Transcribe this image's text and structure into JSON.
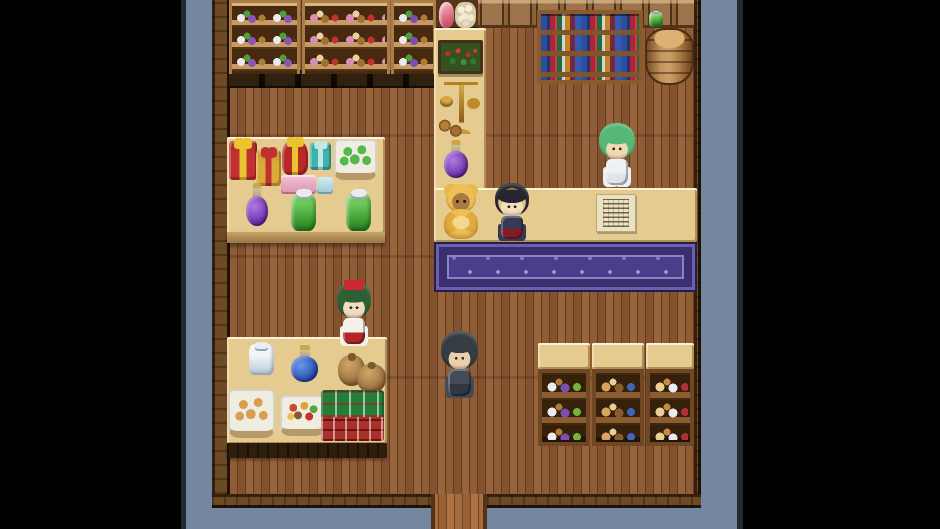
{
  "colors": {
    "letterbox": "#000000",
    "backdrop_blue": "#7487a0",
    "frame_edge": "#232931",
    "wall_brown": "#6d4a26",
    "floor_wood": "#8a5732",
    "corridor_wood": "#9c6538",
    "counter_tan": "#e6cb90",
    "rug_purple": "#4c3c8c",
    "shelf_wood": "#aa7d49",
    "scale_gold": "#d9a845"
  },
  "scene": {
    "width": 940,
    "height": 529,
    "items": [
      {
        "name": "backdrop",
        "cls": "blue",
        "x": 186,
        "y": 0,
        "w": 551,
        "h": 529,
        "interactable": false
      },
      {
        "name": "frame-edge-left",
        "cls": "edge",
        "x": 181,
        "y": 0,
        "w": 5,
        "h": 529,
        "interactable": false
      },
      {
        "name": "frame-edge-right",
        "cls": "edge",
        "x": 737,
        "y": 0,
        "w": 6,
        "h": 529,
        "interactable": false
      },
      {
        "name": "shop-floor",
        "cls": "floor",
        "x": 230,
        "y": 0,
        "w": 464,
        "h": 497,
        "interactable": true
      },
      {
        "name": "wall-west",
        "cls": "wall-v",
        "x": 212,
        "y": 0,
        "w": 18,
        "h": 508,
        "interactable": false
      },
      {
        "name": "wall-east",
        "cls": "wall-v",
        "x": 694,
        "y": 0,
        "w": 7,
        "h": 508,
        "interactable": false
      },
      {
        "name": "wall-south-left",
        "cls": "wall-h",
        "x": 212,
        "y": 494,
        "w": 219,
        "h": 14,
        "interactable": false
      },
      {
        "name": "wall-south-right",
        "cls": "wall-h",
        "x": 487,
        "y": 494,
        "w": 214,
        "h": 14,
        "interactable": false
      },
      {
        "name": "exit-doorway-floor",
        "cls": "floor-exit",
        "x": 431,
        "y": 494,
        "w": 56,
        "h": 35,
        "interactable": true
      },
      {
        "name": "shelf-base-shadow",
        "cls": "shelfbase",
        "x": 229,
        "y": 70,
        "w": 207,
        "h": 18,
        "interactable": false
      },
      {
        "name": "shelf-jars-left",
        "cls": "shelf",
        "x": 229,
        "y": 0,
        "w": 71,
        "h": 74,
        "interactable": false,
        "vars": {
          "--d1": "#ece9f0",
          "--d2": "#8a53b8",
          "--d3": "#b07a38",
          "--d4": "#4f9e3a"
        }
      },
      {
        "name": "shelf-goods-plush",
        "cls": "shelf",
        "x": 302,
        "y": 0,
        "w": 88,
        "h": 74,
        "interactable": false,
        "vars": {
          "--d1": "#d98fb5",
          "--d2": "#a5702f",
          "--d3": "#c23131",
          "--d4": "#e8d3a0"
        }
      },
      {
        "name": "shelf-jars-right",
        "cls": "shelf",
        "x": 391,
        "y": 0,
        "w": 45,
        "h": 74,
        "interactable": false,
        "vars": {
          "--d1": "#ece9f0",
          "--d2": "#7a4fb0",
          "--d3": "#b07a38",
          "--d4": "#4f9e3a"
        }
      },
      {
        "name": "ham-and-eggs-table",
        "cls": "hamtable",
        "x": 436,
        "y": 0,
        "w": 42,
        "h": 30,
        "interactable": false
      },
      {
        "name": "wall-cabinets",
        "cls": "cabinet",
        "x": 478,
        "y": 0,
        "w": 216,
        "h": 28,
        "interactable": false
      },
      {
        "name": "bookshelf",
        "cls": "bookshelf",
        "x": 537,
        "y": 10,
        "w": 106,
        "h": 74,
        "interactable": false
      },
      {
        "name": "barrel",
        "cls": "barrel",
        "x": 645,
        "y": 28,
        "w": 49,
        "h": 57,
        "interactable": false
      },
      {
        "name": "green-box-on-cabinet",
        "cls": "jar-green",
        "x": 649,
        "y": 12,
        "w": 14,
        "h": 15,
        "interactable": false
      },
      {
        "name": "counter-vertical",
        "cls": "tan",
        "x": 434,
        "y": 28,
        "w": 52,
        "h": 214,
        "interactable": false
      },
      {
        "name": "counter-horizontal",
        "cls": "tan",
        "x": 434,
        "y": 188,
        "w": 263,
        "h": 54,
        "interactable": false
      },
      {
        "name": "purple-rug",
        "cls": "rug",
        "x": 434,
        "y": 242,
        "w": 263,
        "h": 50,
        "interactable": false
      },
      {
        "name": "flower-planter",
        "cls": "flowerbox",
        "x": 438,
        "y": 40,
        "w": 45,
        "h": 34,
        "interactable": false
      },
      {
        "name": "balance-scale",
        "cls": "scale",
        "x": 437,
        "y": 80,
        "w": 48,
        "h": 52,
        "interactable": false
      },
      {
        "name": "clay-pots",
        "cls": "pots",
        "x": 437,
        "y": 116,
        "w": 26,
        "h": 24,
        "interactable": false
      },
      {
        "name": "potion-purple-counter",
        "cls": "potion",
        "x": 444,
        "y": 140,
        "w": 24,
        "h": 38,
        "interactable": false,
        "vars": {
          "--liq1": "#b27ae0",
          "--liq2": "#5f24a4"
        }
      },
      {
        "name": "gift-table",
        "cls": "tan",
        "x": 227,
        "y": 137,
        "w": 158,
        "h": 97,
        "interactable": false
      },
      {
        "name": "gift-table-front",
        "cls": "tanfront",
        "x": 227,
        "y": 232,
        "w": 158,
        "h": 11,
        "interactable": false
      },
      {
        "name": "gift-box-red",
        "cls": "gift",
        "x": 229,
        "y": 141,
        "w": 28,
        "h": 39,
        "interactable": false,
        "vars": {
          "--c1": "#c23131",
          "--rb": "#e9c430"
        }
      },
      {
        "name": "gift-box-gold",
        "cls": "gift",
        "x": 256,
        "y": 150,
        "w": 25,
        "h": 36,
        "interactable": false,
        "vars": {
          "--c1": "#dcaa3a",
          "--rb": "#c23131"
        }
      },
      {
        "name": "gift-box-round-red",
        "cls": "gift round",
        "x": 282,
        "y": 140,
        "w": 26,
        "h": 35,
        "interactable": false,
        "vars": {
          "--c1": "#b82a2a",
          "--rb": "#e9c430"
        }
      },
      {
        "name": "gift-box-teal",
        "cls": "gift",
        "x": 310,
        "y": 143,
        "w": 21,
        "h": 27,
        "interactable": false,
        "vars": {
          "--c1": "#3fb3ad",
          "--rb": "#bfe8e6"
        }
      },
      {
        "name": "box-pink",
        "cls": "boxp",
        "x": 281,
        "y": 175,
        "w": 35,
        "h": 19,
        "interactable": false
      },
      {
        "name": "box-teal-small",
        "cls": "boxt",
        "x": 317,
        "y": 177,
        "w": 16,
        "h": 17,
        "interactable": false
      },
      {
        "name": "basket-green-fruit",
        "cls": "basket",
        "x": 334,
        "y": 139,
        "w": 43,
        "h": 41,
        "interactable": false,
        "vars": {
          "--dot": "#54b84a"
        }
      },
      {
        "name": "potion-purple-table",
        "cls": "potion",
        "x": 246,
        "y": 183,
        "w": 22,
        "h": 43,
        "interactable": false,
        "vars": {
          "--liq1": "#b27ae0",
          "--liq2": "#5f24a4"
        }
      },
      {
        "name": "jar-green-left",
        "cls": "jar-green",
        "x": 291,
        "y": 193,
        "w": 25,
        "h": 38,
        "interactable": false
      },
      {
        "name": "jar-green-right",
        "cls": "jar-green",
        "x": 346,
        "y": 193,
        "w": 25,
        "h": 38,
        "interactable": false
      },
      {
        "name": "provisions-table",
        "cls": "tan",
        "x": 227,
        "y": 337,
        "w": 160,
        "h": 107,
        "interactable": false
      },
      {
        "name": "provisions-table-front",
        "cls": "darkfront",
        "x": 227,
        "y": 443,
        "w": 160,
        "h": 15,
        "interactable": false
      },
      {
        "name": "jar-white-salt",
        "cls": "jar-white",
        "x": 249,
        "y": 344,
        "w": 25,
        "h": 31,
        "interactable": false
      },
      {
        "name": "potion-blue",
        "cls": "potion",
        "x": 291,
        "y": 345,
        "w": 27,
        "h": 37,
        "interactable": false,
        "vars": {
          "--liq1": "#6a9ae8",
          "--liq2": "#1c3fa8"
        }
      },
      {
        "name": "sack-back",
        "cls": "sack",
        "x": 338,
        "y": 355,
        "w": 27,
        "h": 31,
        "interactable": false
      },
      {
        "name": "sack-front",
        "cls": "sack",
        "x": 357,
        "y": 364,
        "w": 29,
        "h": 29,
        "interactable": false
      },
      {
        "name": "basket-bread",
        "cls": "basket",
        "x": 228,
        "y": 389,
        "w": 47,
        "h": 49,
        "interactable": false,
        "vars": {
          "--dot": "#d99f4e"
        }
      },
      {
        "name": "basket-vegetables",
        "cls": "basket mixed",
        "x": 280,
        "y": 395,
        "w": 45,
        "h": 41,
        "interactable": false
      },
      {
        "name": "plaid-cloth",
        "cls": "plaid",
        "x": 321,
        "y": 390,
        "w": 63,
        "h": 51,
        "interactable": false
      },
      {
        "name": "teddy-bear-plush",
        "cls": "teddy",
        "x": 442,
        "y": 184,
        "w": 38,
        "h": 55,
        "interactable": false
      },
      {
        "name": "npc-girl-bonnet",
        "cls": "chibi",
        "x": 492,
        "y": 182,
        "w": 40,
        "h": 58,
        "interactable": true,
        "vars": {
          "--hair": "#26262e",
          "--hairmid": "#e2c87c",
          "--skin": "#f2ddc0",
          "--body": "#333a54",
          "--skirt": "#7e1c28"
        }
      },
      {
        "name": "price-list-paper",
        "cls": "paper",
        "x": 596,
        "y": 194,
        "w": 40,
        "h": 38,
        "interactable": false
      },
      {
        "name": "npc-shopkeeper",
        "cls": "chibi",
        "x": 596,
        "y": 122,
        "w": 42,
        "h": 64,
        "interactable": true,
        "vars": {
          "--hair": "#55b878",
          "--skin": "#f2d9b6",
          "--body": "#eef1f4",
          "--skirt": "#dfe4ea"
        }
      },
      {
        "name": "npc-shrine-maiden",
        "cls": "chibi",
        "x": 334,
        "y": 280,
        "w": 40,
        "h": 65,
        "interactable": true,
        "vars": {
          "--hair": "#2e5f35",
          "--skin": "#f2dcc0",
          "--body": "#f3f1ec",
          "--skirt": "#b22626"
        }
      },
      {
        "name": "maiden-hair-bow",
        "cls": "bow",
        "x": 344,
        "y": 280,
        "w": 20,
        "h": 10,
        "interactable": false
      },
      {
        "name": "player-character",
        "cls": "chibi",
        "x": 438,
        "y": 330,
        "w": 43,
        "h": 67,
        "interactable": true,
        "vars": {
          "--hair": "#333d42",
          "--skin": "#eccfae",
          "--body": "#434b58",
          "--skirt": "#303740"
        }
      },
      {
        "name": "shelf-right-1-top",
        "cls": "tan",
        "x": 538,
        "y": 343,
        "w": 52,
        "h": 26,
        "interactable": false
      },
      {
        "name": "shelf-right-1",
        "cls": "shelf2",
        "x": 538,
        "y": 369,
        "w": 52,
        "h": 77,
        "interactable": false,
        "vars": {
          "--d1": "#ece9f0",
          "--d2": "#7a4fb0",
          "--d3": "#73b53c",
          "--d4": "#b07a38"
        }
      },
      {
        "name": "shelf-right-2-top",
        "cls": "tan",
        "x": 592,
        "y": 343,
        "w": 52,
        "h": 26,
        "interactable": false
      },
      {
        "name": "shelf-right-2",
        "cls": "shelf2",
        "x": 592,
        "y": 369,
        "w": 52,
        "h": 77,
        "interactable": false,
        "vars": {
          "--d1": "#d9a45c",
          "--d2": "#8a5a28",
          "--d3": "#3f63c0",
          "--d4": "#e8cf96"
        }
      },
      {
        "name": "shelf-right-3-top",
        "cls": "tan",
        "x": 646,
        "y": 343,
        "w": 48,
        "h": 26,
        "interactable": false
      },
      {
        "name": "shelf-right-3",
        "cls": "shelf2",
        "x": 646,
        "y": 369,
        "w": 48,
        "h": 77,
        "interactable": false,
        "vars": {
          "--d1": "#e8cf96",
          "--d2": "#ece9f0",
          "--d3": "#b03038",
          "--d4": "#c98a3e"
        }
      }
    ]
  }
}
